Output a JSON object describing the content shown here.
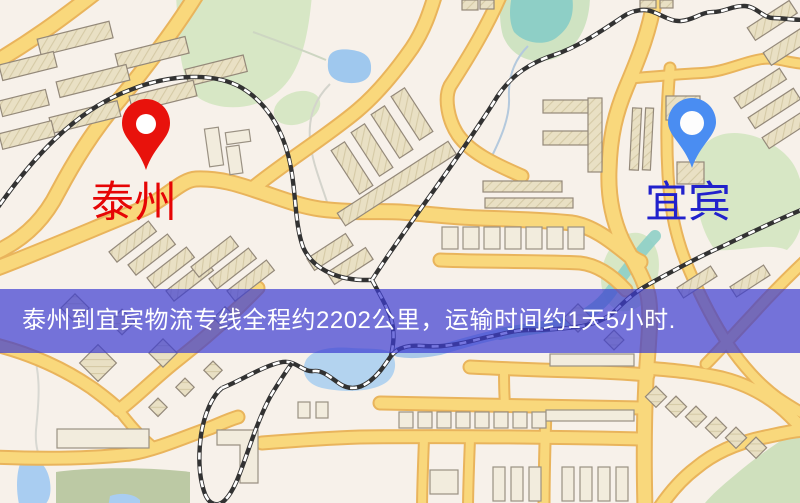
{
  "banner": {
    "text": "泰州到宜宾物流专线全程约2202公里，运输时间约1天5小时.",
    "background": "rgba(60,60,210,0.70)",
    "text_color": "#ffffff"
  },
  "origin": {
    "label": "泰州",
    "pin_color": "#e8120c",
    "pin_hole_color": "#ffffff",
    "label_color": "#e60505"
  },
  "destination": {
    "label": "宜宾",
    "pin_color": "#4a8df2",
    "pin_hole_color": "#fdfdfd",
    "label_color": "#2121cc"
  },
  "map_palette": {
    "background": "#f7f1ea",
    "road_fill": "#f9d87c",
    "road_casing": "#e9b45c",
    "park_green": "#d7e7c5",
    "field_green": "#bcc9a4",
    "water_blue": "#a9cdf1",
    "river_teal": "#8ecfc6",
    "building": "#e9e0c4",
    "railway": "#323232"
  }
}
